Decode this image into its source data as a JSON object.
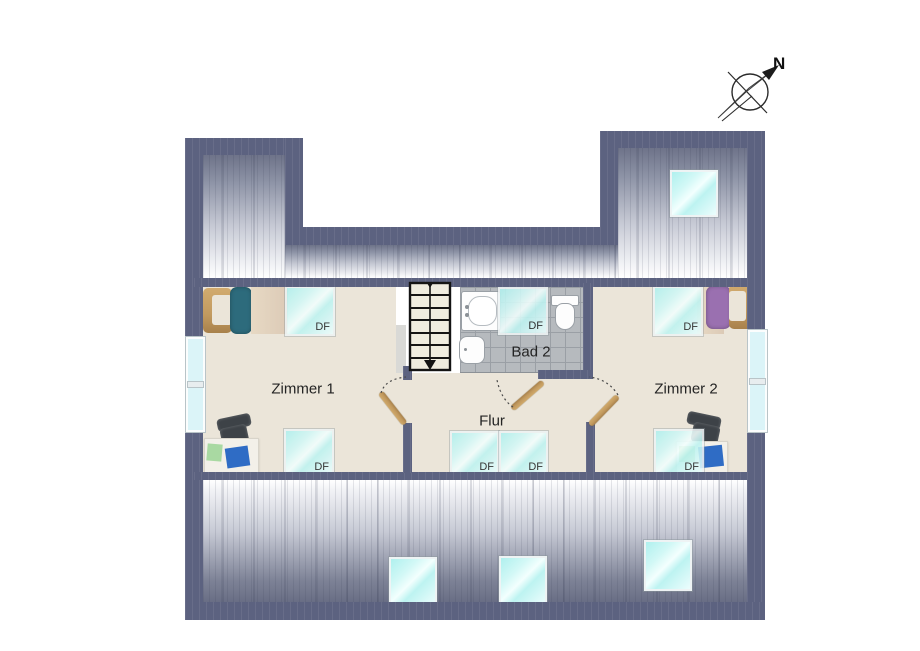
{
  "plan": {
    "compass_label": "N",
    "rooms": [
      {
        "id": "zimmer1",
        "label": "Zimmer 1"
      },
      {
        "id": "flur",
        "label": "Flur"
      },
      {
        "id": "bad2",
        "label": "Bad 2"
      },
      {
        "id": "zimmer2",
        "label": "Zimmer 2"
      }
    ],
    "skylight_code": "DF",
    "labeled_skylight_count": 7,
    "unlabeled_skylight_count": 4
  },
  "colors": {
    "wall": "#5c6280",
    "floor": "#ebe5d9",
    "tile": "#b6babe",
    "tileline": "#9a9fa5",
    "roofdark": "#6e7389",
    "rooflight": "#f2f3f6",
    "skya": "#aff0ee",
    "skyb": "#ecfdfd",
    "glass": "#dbf4f8",
    "wood": "#c29a5f",
    "wooddark": "#a8814b",
    "blanket": "#dccab6",
    "pillowteal": "#2d6b7c",
    "pillowpurple": "#9a70b0",
    "chair": "#3d4247",
    "desk": "#f3f0e9",
    "papergreen": "#a9d9a2",
    "paperblue": "#2f6cc5",
    "ink": "#222222"
  }
}
